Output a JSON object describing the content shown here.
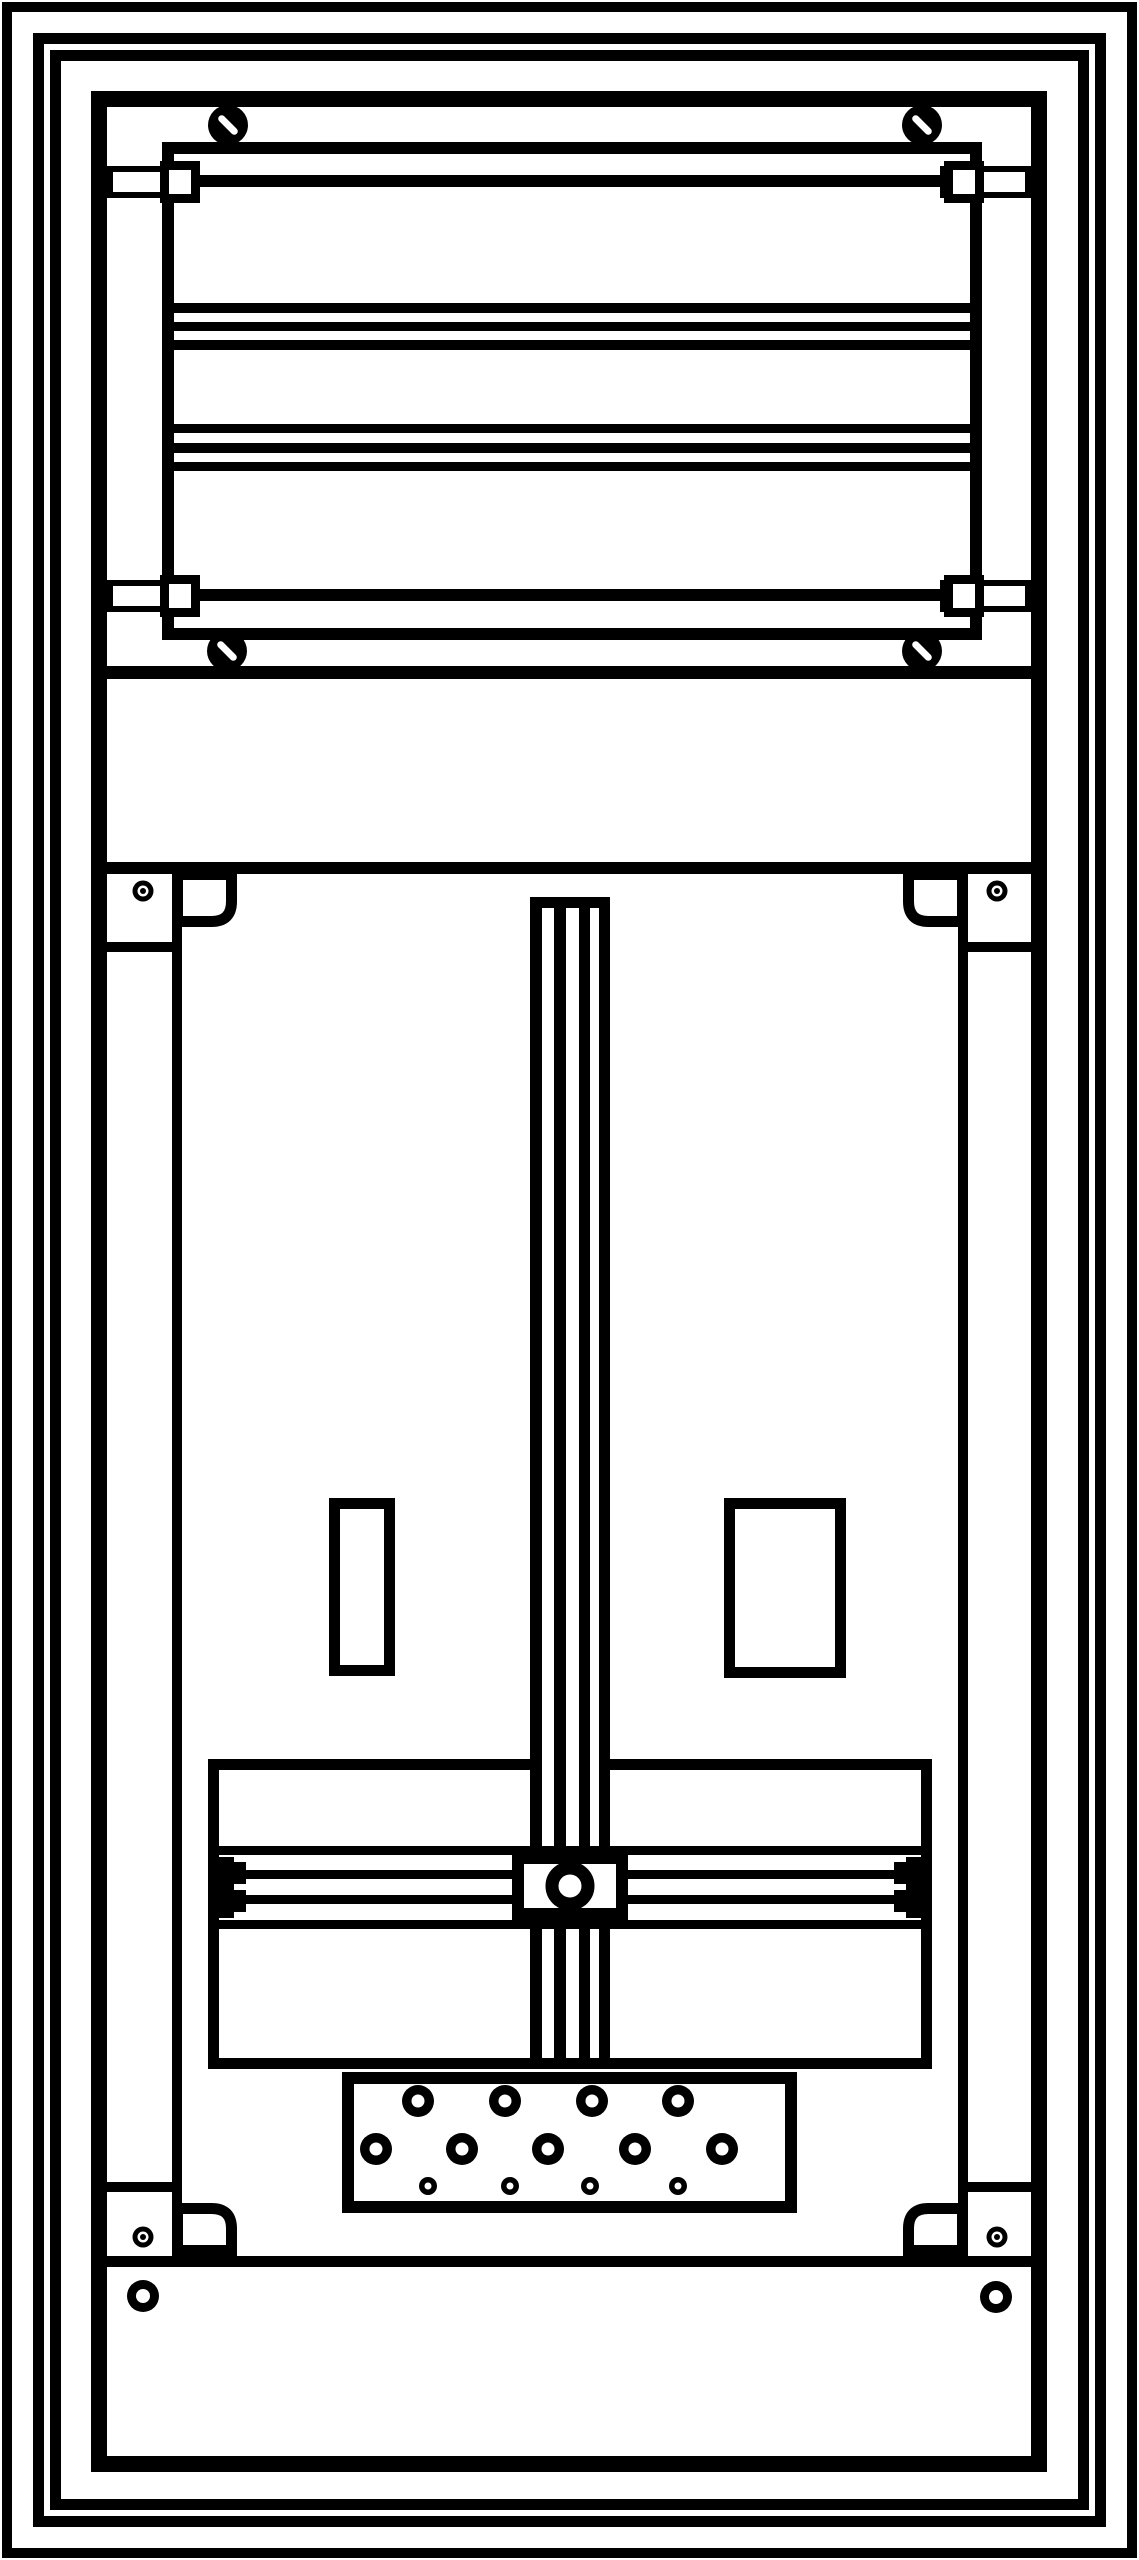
{
  "meta": {
    "title": "meter-cabinet-technical-drawing",
    "background": "#ffffff",
    "ink": "#000000",
    "width": 1139,
    "height": 2560
  },
  "diagram": {
    "shapes": [
      {
        "name": "outer-frame-1",
        "type": "orect",
        "x": 7,
        "y": 7,
        "w": 1125,
        "h": 2546,
        "sw": 10
      },
      {
        "name": "outer-frame-2",
        "type": "orect",
        "x": 38.5,
        "y": 38.5,
        "w": 1062,
        "h": 2483,
        "sw": 11
      },
      {
        "name": "outer-frame-3",
        "type": "orect",
        "x": 55.5,
        "y": 55.5,
        "w": 1028,
        "h": 2449,
        "sw": 11
      },
      {
        "name": "cabinet-body",
        "type": "orect",
        "x": 99,
        "y": 99,
        "w": 940,
        "h": 2365,
        "sw": 16
      },
      {
        "name": "equipment-frame",
        "type": "orect",
        "x": 168,
        "y": 148,
        "w": 808,
        "h": 486,
        "sw": 12
      },
      {
        "name": "rail1-endplate-left",
        "type": "orect",
        "x": 110,
        "y": 169,
        "w": 85,
        "h": 26,
        "sw": 6,
        "fill": "#ffffff"
      },
      {
        "name": "rail1-endplate-right",
        "type": "orect",
        "x": 943,
        "y": 169,
        "w": 85,
        "h": 26,
        "sw": 6,
        "fill": "#ffffff"
      },
      {
        "name": "rail1-claw-left",
        "type": "orect",
        "x": 164.5,
        "y": 165.5,
        "w": 31,
        "h": 33,
        "sw": 9,
        "fill": "#ffffff"
      },
      {
        "name": "rail1-claw-right",
        "type": "orect",
        "x": 948.5,
        "y": 165.5,
        "w": 31,
        "h": 33,
        "sw": 9,
        "fill": "#ffffff"
      },
      {
        "name": "rail1-bar",
        "type": "frect",
        "x": 197,
        "y": 175,
        "w": 750,
        "h": 12
      },
      {
        "name": "busbar-a1",
        "type": "frect",
        "x": 174,
        "y": 303,
        "w": 796,
        "h": 10
      },
      {
        "name": "busbar-a2",
        "type": "frect",
        "x": 174,
        "y": 322,
        "w": 796,
        "h": 9
      },
      {
        "name": "busbar-a3",
        "type": "frect",
        "x": 174,
        "y": 340,
        "w": 796,
        "h": 10
      },
      {
        "name": "busbar-b1",
        "type": "frect",
        "x": 174,
        "y": 424,
        "w": 796,
        "h": 9
      },
      {
        "name": "busbar-b2",
        "type": "frect",
        "x": 174,
        "y": 443,
        "w": 796,
        "h": 10
      },
      {
        "name": "busbar-b3",
        "type": "frect",
        "x": 174,
        "y": 462,
        "w": 796,
        "h": 9
      },
      {
        "name": "rail2-endplate-left",
        "type": "orect",
        "x": 110,
        "y": 583,
        "w": 85,
        "h": 26,
        "sw": 6,
        "fill": "#ffffff"
      },
      {
        "name": "rail2-endplate-right",
        "type": "orect",
        "x": 943,
        "y": 583,
        "w": 85,
        "h": 26,
        "sw": 6,
        "fill": "#ffffff"
      },
      {
        "name": "rail2-claw-left",
        "type": "orect",
        "x": 164.5,
        "y": 579.5,
        "w": 31,
        "h": 33,
        "sw": 9,
        "fill": "#ffffff"
      },
      {
        "name": "rail2-claw-right",
        "type": "orect",
        "x": 948.5,
        "y": 579.5,
        "w": 31,
        "h": 33,
        "sw": 9,
        "fill": "#ffffff"
      },
      {
        "name": "rail2-bar",
        "type": "frect",
        "x": 197,
        "y": 589,
        "w": 750,
        "h": 12
      },
      {
        "name": "screw-top-left",
        "type": "screw",
        "cx": 228,
        "cy": 125,
        "r": 20,
        "angle": -45
      },
      {
        "name": "screw-top-right",
        "type": "screw",
        "cx": 922,
        "cy": 125,
        "r": 20,
        "angle": -45
      },
      {
        "name": "screw-bottom-left",
        "type": "screw",
        "cx": 227,
        "cy": 651,
        "r": 20,
        "angle": -45
      },
      {
        "name": "screw-bottom-right",
        "type": "screw",
        "cx": 922,
        "cy": 651,
        "r": 20,
        "angle": -45
      },
      {
        "name": "divider-top",
        "type": "frect",
        "x": 107,
        "y": 666,
        "w": 926,
        "h": 13
      },
      {
        "name": "divider-middle",
        "type": "frect",
        "x": 107,
        "y": 862,
        "w": 926,
        "h": 12
      },
      {
        "name": "divider-bottom",
        "type": "frect",
        "x": 107,
        "y": 2256,
        "w": 926,
        "h": 11
      },
      {
        "name": "side-rail-left",
        "type": "frect",
        "x": 172,
        "y": 874,
        "w": 10,
        "h": 1382
      },
      {
        "name": "side-rail-right",
        "type": "frect",
        "x": 958,
        "y": 874,
        "w": 10,
        "h": 1382
      },
      {
        "name": "side-step-top-left",
        "type": "frect",
        "x": 107,
        "y": 942,
        "w": 65,
        "h": 10
      },
      {
        "name": "side-step-top-right",
        "type": "frect",
        "x": 968,
        "y": 942,
        "w": 65,
        "h": 10
      },
      {
        "name": "side-step-bottom-left",
        "type": "frect",
        "x": 107,
        "y": 2182,
        "w": 65,
        "h": 10
      },
      {
        "name": "side-step-bottom-right",
        "type": "frect",
        "x": 968,
        "y": 2182,
        "w": 65,
        "h": 10
      },
      {
        "name": "bracket-top-left",
        "type": "bracket",
        "x": 177.5,
        "y": 874.5,
        "w": 54,
        "h": 47,
        "corner": "br",
        "r": 20,
        "sw": 11
      },
      {
        "name": "bracket-top-right",
        "type": "bracket",
        "x": 908.5,
        "y": 874.5,
        "w": 54,
        "h": 47,
        "corner": "bl",
        "r": 20,
        "sw": 11
      },
      {
        "name": "bracket-bottom-left",
        "type": "bracket",
        "x": 177.5,
        "y": 2208.5,
        "w": 54,
        "h": 42,
        "corner": "tr",
        "r": 20,
        "sw": 11
      },
      {
        "name": "bracket-bottom-right",
        "type": "bracket",
        "x": 908.5,
        "y": 2208.5,
        "w": 54,
        "h": 42,
        "corner": "tl",
        "r": 20,
        "sw": 11
      },
      {
        "name": "fixing-hole-top-left",
        "type": "hole",
        "cx": 143,
        "cy": 891,
        "ro": 10.5,
        "ri": 5.5,
        "dot": 3
      },
      {
        "name": "fixing-hole-top-right",
        "type": "hole",
        "cx": 997,
        "cy": 891,
        "ro": 10.5,
        "ri": 5.5,
        "dot": 3
      },
      {
        "name": "fixing-hole-mid-left",
        "type": "hole",
        "cx": 143,
        "cy": 2237,
        "ro": 10.5,
        "ri": 5.5,
        "dot": 3
      },
      {
        "name": "fixing-hole-mid-right",
        "type": "hole",
        "cx": 997,
        "cy": 2237,
        "ro": 10.5,
        "ri": 5.5,
        "dot": 3
      },
      {
        "name": "cutout-left",
        "type": "orect",
        "x": 334.5,
        "y": 1503.5,
        "w": 55,
        "h": 167,
        "sw": 11,
        "fill": "#ffffff"
      },
      {
        "name": "cutout-right",
        "type": "orect",
        "x": 729.5,
        "y": 1503.5,
        "w": 111,
        "h": 169,
        "sw": 11,
        "fill": "#ffffff"
      },
      {
        "name": "mounting-plate",
        "type": "orect",
        "x": 213.5,
        "y": 1764.5,
        "w": 713,
        "h": 299,
        "sw": 11,
        "fill": "#ffffff"
      },
      {
        "name": "din-rail-bg",
        "type": "frect",
        "x": 530,
        "y": 897,
        "w": 80,
        "h": 1161,
        "fill": "#ffffff"
      },
      {
        "name": "din-rail-line-1",
        "type": "frect",
        "x": 530,
        "y": 897,
        "w": 12,
        "h": 1161
      },
      {
        "name": "din-rail-line-2",
        "type": "frect",
        "x": 554,
        "y": 897,
        "w": 12,
        "h": 1161
      },
      {
        "name": "din-rail-line-3",
        "type": "frect",
        "x": 579,
        "y": 897,
        "w": 11,
        "h": 1161
      },
      {
        "name": "din-rail-line-4",
        "type": "frect",
        "x": 599,
        "y": 897,
        "w": 11,
        "h": 1161
      },
      {
        "name": "din-rail-top-cap",
        "type": "frect",
        "x": 530,
        "y": 897,
        "w": 80,
        "h": 11
      },
      {
        "name": "crossbar-top",
        "type": "frect",
        "x": 218,
        "y": 1846,
        "w": 704,
        "h": 9
      },
      {
        "name": "crossbar-bottom",
        "type": "frect",
        "x": 218,
        "y": 1920,
        "w": 704,
        "h": 9
      },
      {
        "name": "crossbar-line-a",
        "type": "frect",
        "x": 235,
        "y": 1870,
        "w": 670,
        "h": 9
      },
      {
        "name": "crossbar-line-b",
        "type": "frect",
        "x": 235,
        "y": 1895,
        "w": 670,
        "h": 9
      },
      {
        "name": "crossbar-cap-left",
        "type": "frect",
        "x": 218,
        "y": 1857,
        "w": 16,
        "h": 61
      },
      {
        "name": "crossbar-cap-left-hook-top",
        "type": "frect",
        "x": 234,
        "y": 1862,
        "w": 12,
        "h": 22
      },
      {
        "name": "crossbar-cap-left-hook-bottom",
        "type": "frect",
        "x": 234,
        "y": 1890,
        "w": 12,
        "h": 22
      },
      {
        "name": "crossbar-cap-right",
        "type": "frect",
        "x": 906,
        "y": 1857,
        "w": 16,
        "h": 61
      },
      {
        "name": "crossbar-cap-right-hook-top",
        "type": "frect",
        "x": 894,
        "y": 1862,
        "w": 12,
        "h": 22
      },
      {
        "name": "crossbar-cap-right-hook-bottom",
        "type": "frect",
        "x": 894,
        "y": 1890,
        "w": 12,
        "h": 22
      },
      {
        "name": "center-block",
        "type": "orect",
        "x": 518,
        "y": 1858,
        "w": 104,
        "h": 56,
        "sw": 12,
        "fill": "#ffffff"
      },
      {
        "name": "center-block-hole",
        "type": "circle",
        "cx": 570,
        "cy": 1886,
        "r": 18,
        "sw": 13
      },
      {
        "name": "gland-plate",
        "type": "orect",
        "x": 348,
        "y": 2078,
        "w": 443,
        "h": 129,
        "sw": 12,
        "fill": "#ffffff"
      },
      {
        "name": "gland-hole-r1-1",
        "type": "hole",
        "cx": 418,
        "cy": 2101,
        "ro": 16,
        "ri": 6.5
      },
      {
        "name": "gland-hole-r1-2",
        "type": "hole",
        "cx": 505,
        "cy": 2101,
        "ro": 16,
        "ri": 6.5
      },
      {
        "name": "gland-hole-r1-3",
        "type": "hole",
        "cx": 592,
        "cy": 2101,
        "ro": 16,
        "ri": 6.5
      },
      {
        "name": "gland-hole-r1-4",
        "type": "hole",
        "cx": 678,
        "cy": 2101,
        "ro": 16,
        "ri": 6.5
      },
      {
        "name": "gland-hole-r2-1",
        "type": "hole",
        "cx": 376,
        "cy": 2149,
        "ro": 16,
        "ri": 6.5
      },
      {
        "name": "gland-hole-r2-2",
        "type": "hole",
        "cx": 462,
        "cy": 2149,
        "ro": 16,
        "ri": 6.5
      },
      {
        "name": "gland-hole-r2-3",
        "type": "hole",
        "cx": 548,
        "cy": 2149,
        "ro": 16,
        "ri": 6.5
      },
      {
        "name": "gland-hole-r2-4",
        "type": "hole",
        "cx": 635,
        "cy": 2149,
        "ro": 16,
        "ri": 6.5
      },
      {
        "name": "gland-hole-r2-5",
        "type": "hole",
        "cx": 722,
        "cy": 2149,
        "ro": 16,
        "ri": 6.5
      },
      {
        "name": "gland-hole-r3-1",
        "type": "hole",
        "cx": 428,
        "cy": 2186,
        "ro": 9,
        "ri": 3.5
      },
      {
        "name": "gland-hole-r3-2",
        "type": "hole",
        "cx": 510,
        "cy": 2186,
        "ro": 9,
        "ri": 3.5
      },
      {
        "name": "gland-hole-r3-3",
        "type": "hole",
        "cx": 590,
        "cy": 2186,
        "ro": 9,
        "ri": 3.5
      },
      {
        "name": "gland-hole-r3-4",
        "type": "hole",
        "cx": 678,
        "cy": 2186,
        "ro": 9,
        "ri": 3.5
      },
      {
        "name": "bottom-panel-hole-left",
        "type": "hole",
        "cx": 143,
        "cy": 2296,
        "ro": 16,
        "ri": 7
      },
      {
        "name": "bottom-panel-hole-right",
        "type": "hole",
        "cx": 996,
        "cy": 2297,
        "ro": 16,
        "ri": 7
      }
    ]
  }
}
